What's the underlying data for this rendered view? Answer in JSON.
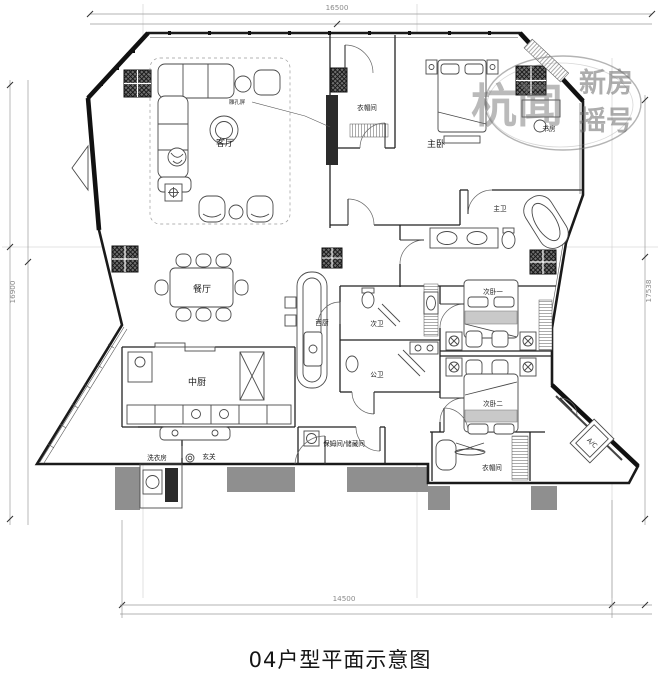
{
  "title": "04户型平面示意图",
  "dimensions": {
    "top": "16500",
    "left": "16900",
    "right": "17538",
    "bottom": "14500"
  },
  "watermark": {
    "big": "杭闻",
    "top": "新房",
    "bottom": "摇号"
  },
  "annotations": {
    "screen": "雕孔屏",
    "ac": "A/C"
  },
  "rooms": {
    "living": "客厅",
    "dining": "餐厅",
    "cloak_top": "衣帽间",
    "master_bed": "主卧",
    "study": "书房",
    "master_bath": "主卫",
    "second_bath": "次卫",
    "public_bath": "公卫",
    "west_kitchen": "西厨",
    "chinese_kitchen": "中厨",
    "laundry": "洗衣房",
    "foyer": "玄关",
    "nanny": "保姆间/储藏间",
    "bedroom2_1": "次卧一",
    "bedroom2_2": "次卧二",
    "cloak_bottom": "衣帽间"
  }
}
